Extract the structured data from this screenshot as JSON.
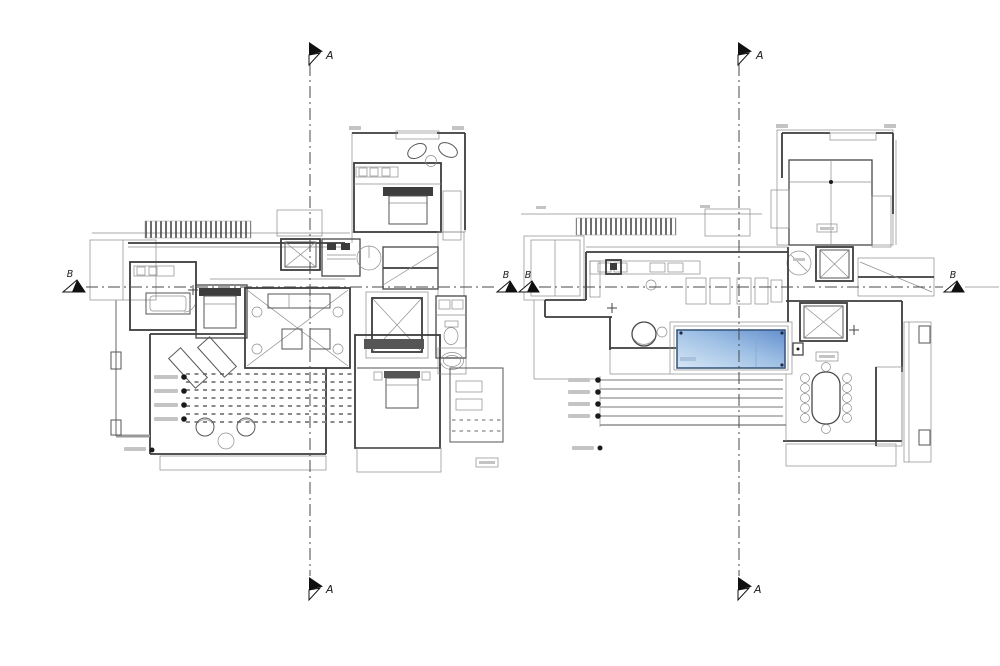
{
  "canvas": {
    "width": 1000,
    "height": 666,
    "background": "#ffffff"
  },
  "sections": {
    "a_label": "A",
    "b_label": "B"
  },
  "colors": {
    "pool_light": "#d7e7f6",
    "pool_mid": "#9dbfe4",
    "pool_dark": "#6590cf",
    "pool_edge": "#3c5a82"
  }
}
